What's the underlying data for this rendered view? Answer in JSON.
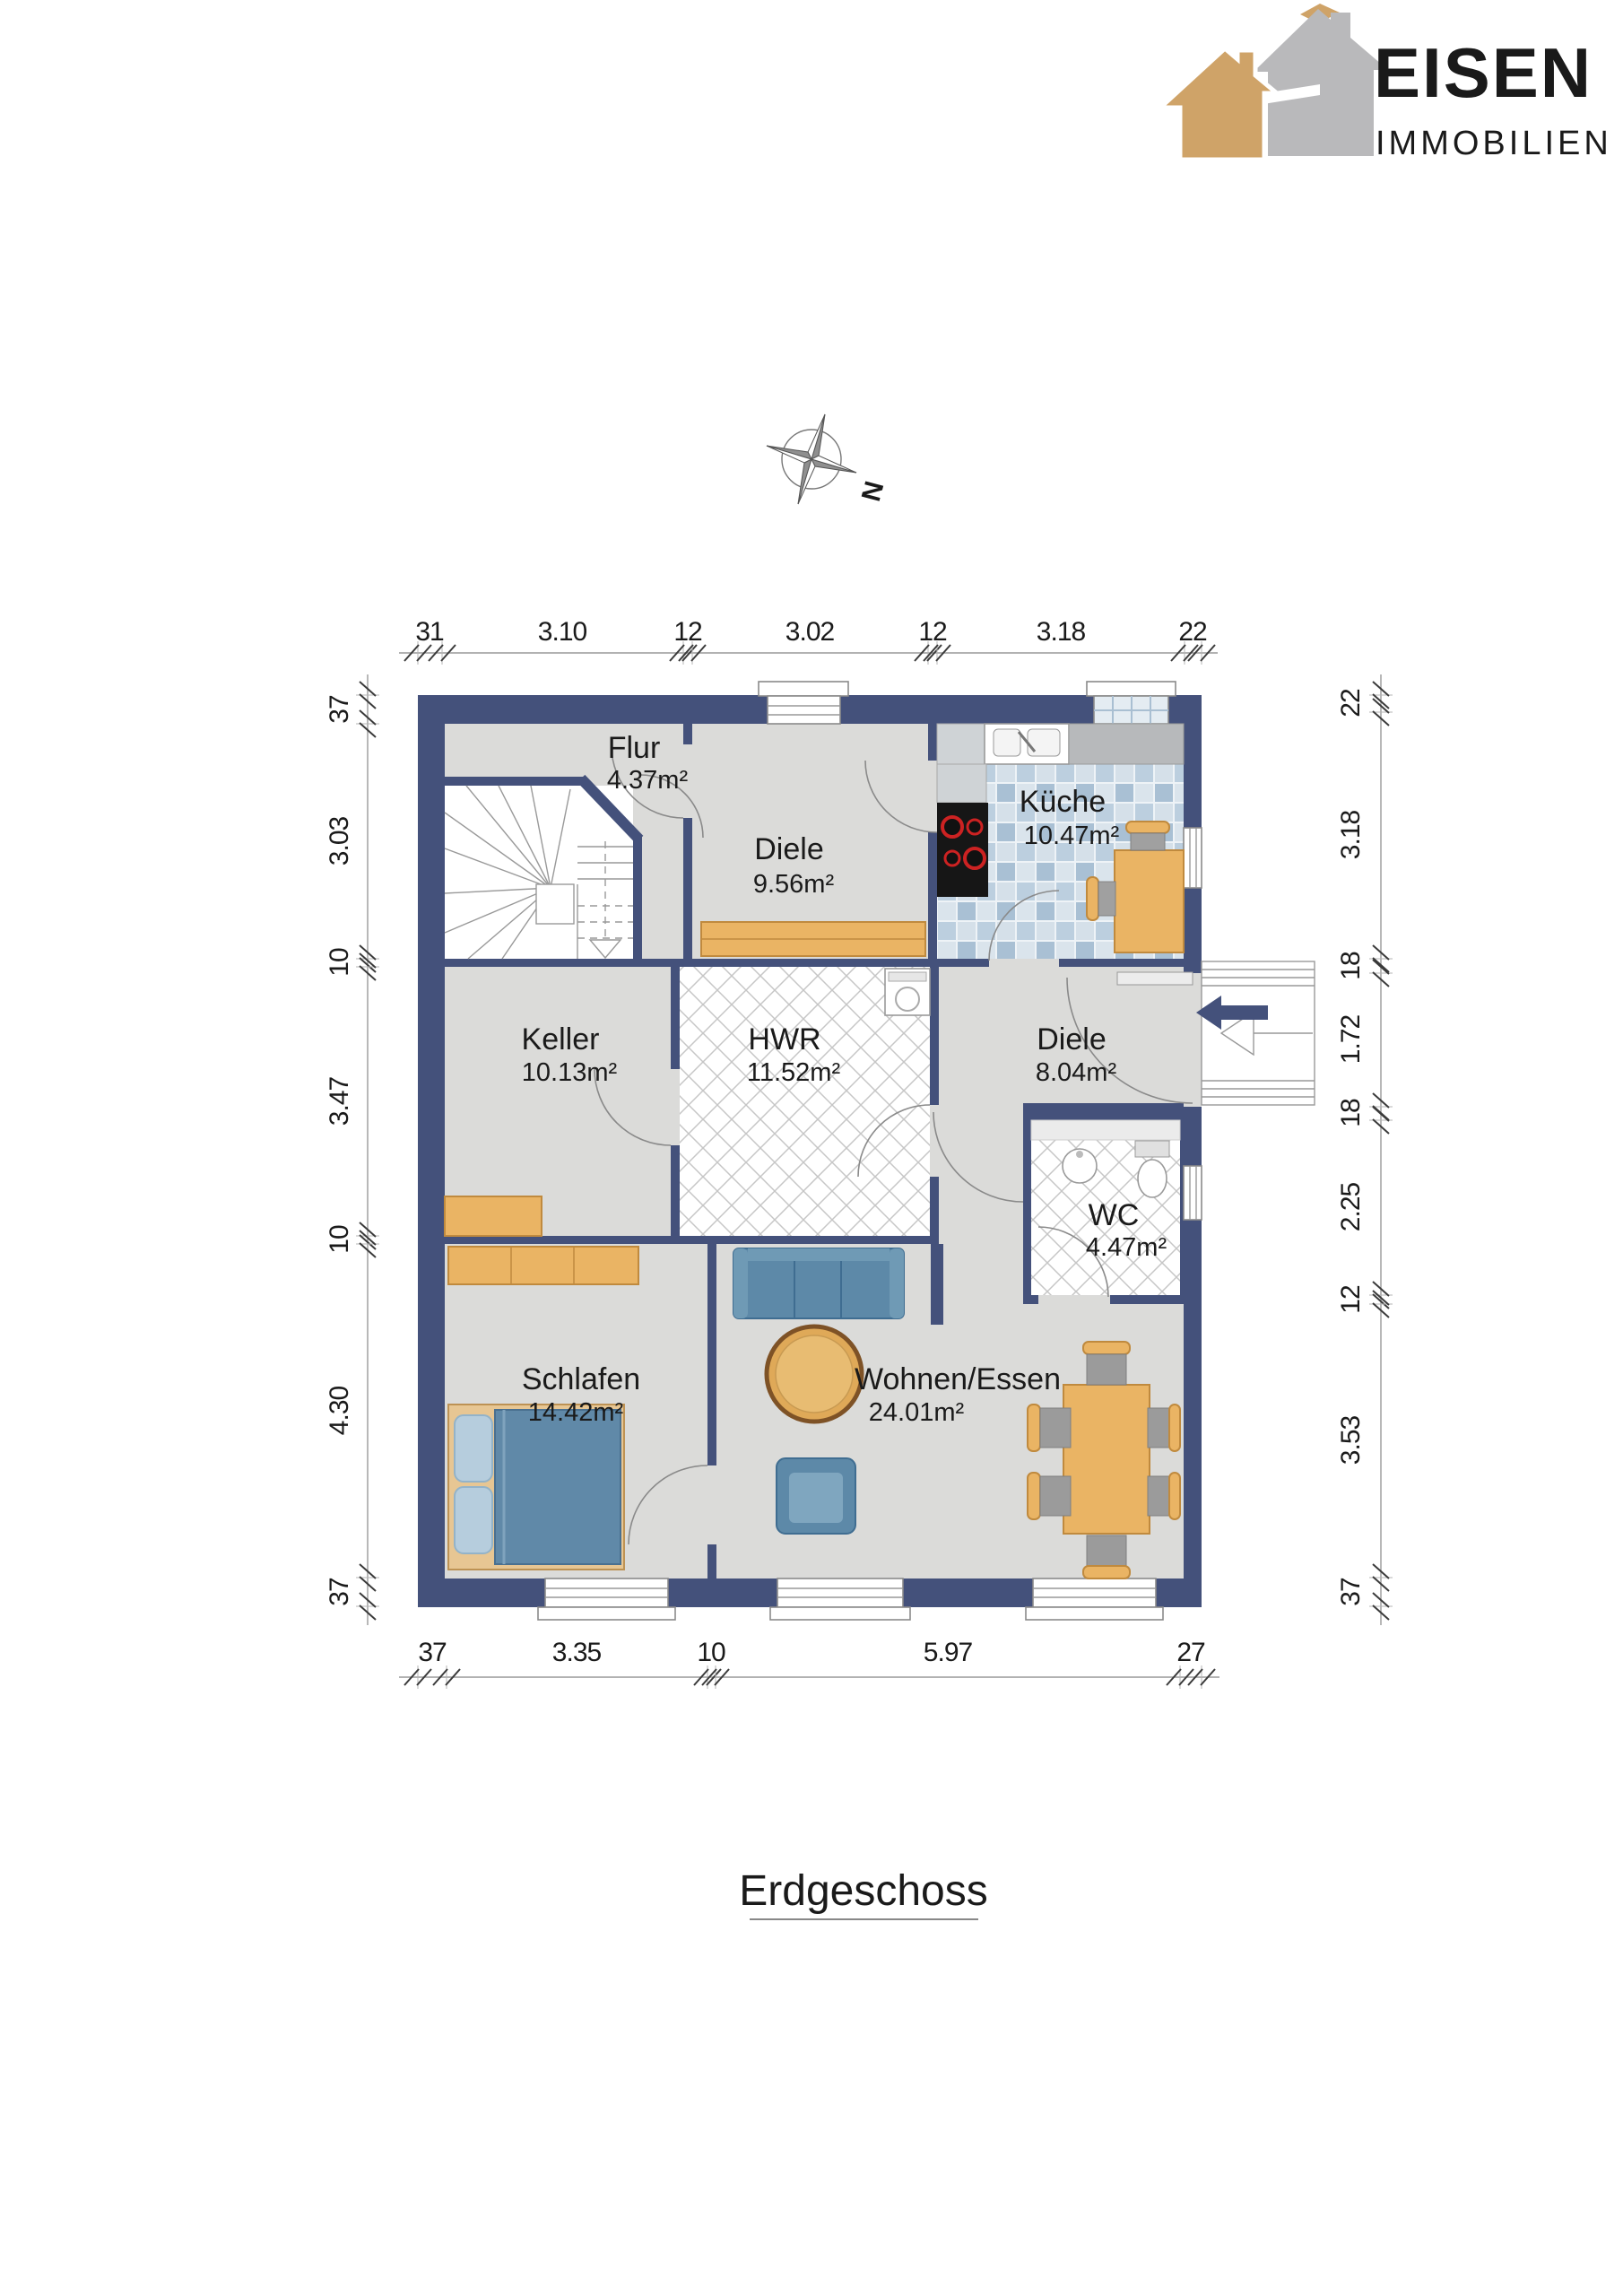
{
  "logo": {
    "brand": "EISEN",
    "sub": "IMMOBILIEN",
    "gold": "#cfa368",
    "gray": "#b5b5b7"
  },
  "title": {
    "text": "Erdgeschoss"
  },
  "compass": {
    "label": "N"
  },
  "plan": {
    "wall_color": "#44517b",
    "floor_color": "#dbdbd9",
    "rooms": [
      {
        "name": "Flur",
        "area": "4.37m²"
      },
      {
        "name": "Diele",
        "area": "9.56m²"
      },
      {
        "name": "Küche",
        "area": "10.47m²"
      },
      {
        "name": "Keller",
        "area": "10.13m²"
      },
      {
        "name": "HWR",
        "area": "11.52m²"
      },
      {
        "name": "Diele",
        "area": "8.04m²"
      },
      {
        "name": "WC",
        "area": "4.47m²"
      },
      {
        "name": "Schlafen",
        "area": "14.42m²"
      },
      {
        "name": "Wohnen/Essen",
        "area": "24.01m²"
      }
    ],
    "dimensions": {
      "top": [
        "31",
        "3.10",
        "12",
        "3.02",
        "12",
        "3.18",
        "22"
      ],
      "left": [
        "37",
        "3.03",
        "10",
        "3.47",
        "10",
        "4.30",
        "37"
      ],
      "right": [
        "22",
        "3.18",
        "18",
        "1.72",
        "18",
        "2.25",
        "12",
        "3.53",
        "37"
      ],
      "bottom": [
        "37",
        "3.35",
        "10",
        "5.97",
        "27"
      ]
    }
  }
}
